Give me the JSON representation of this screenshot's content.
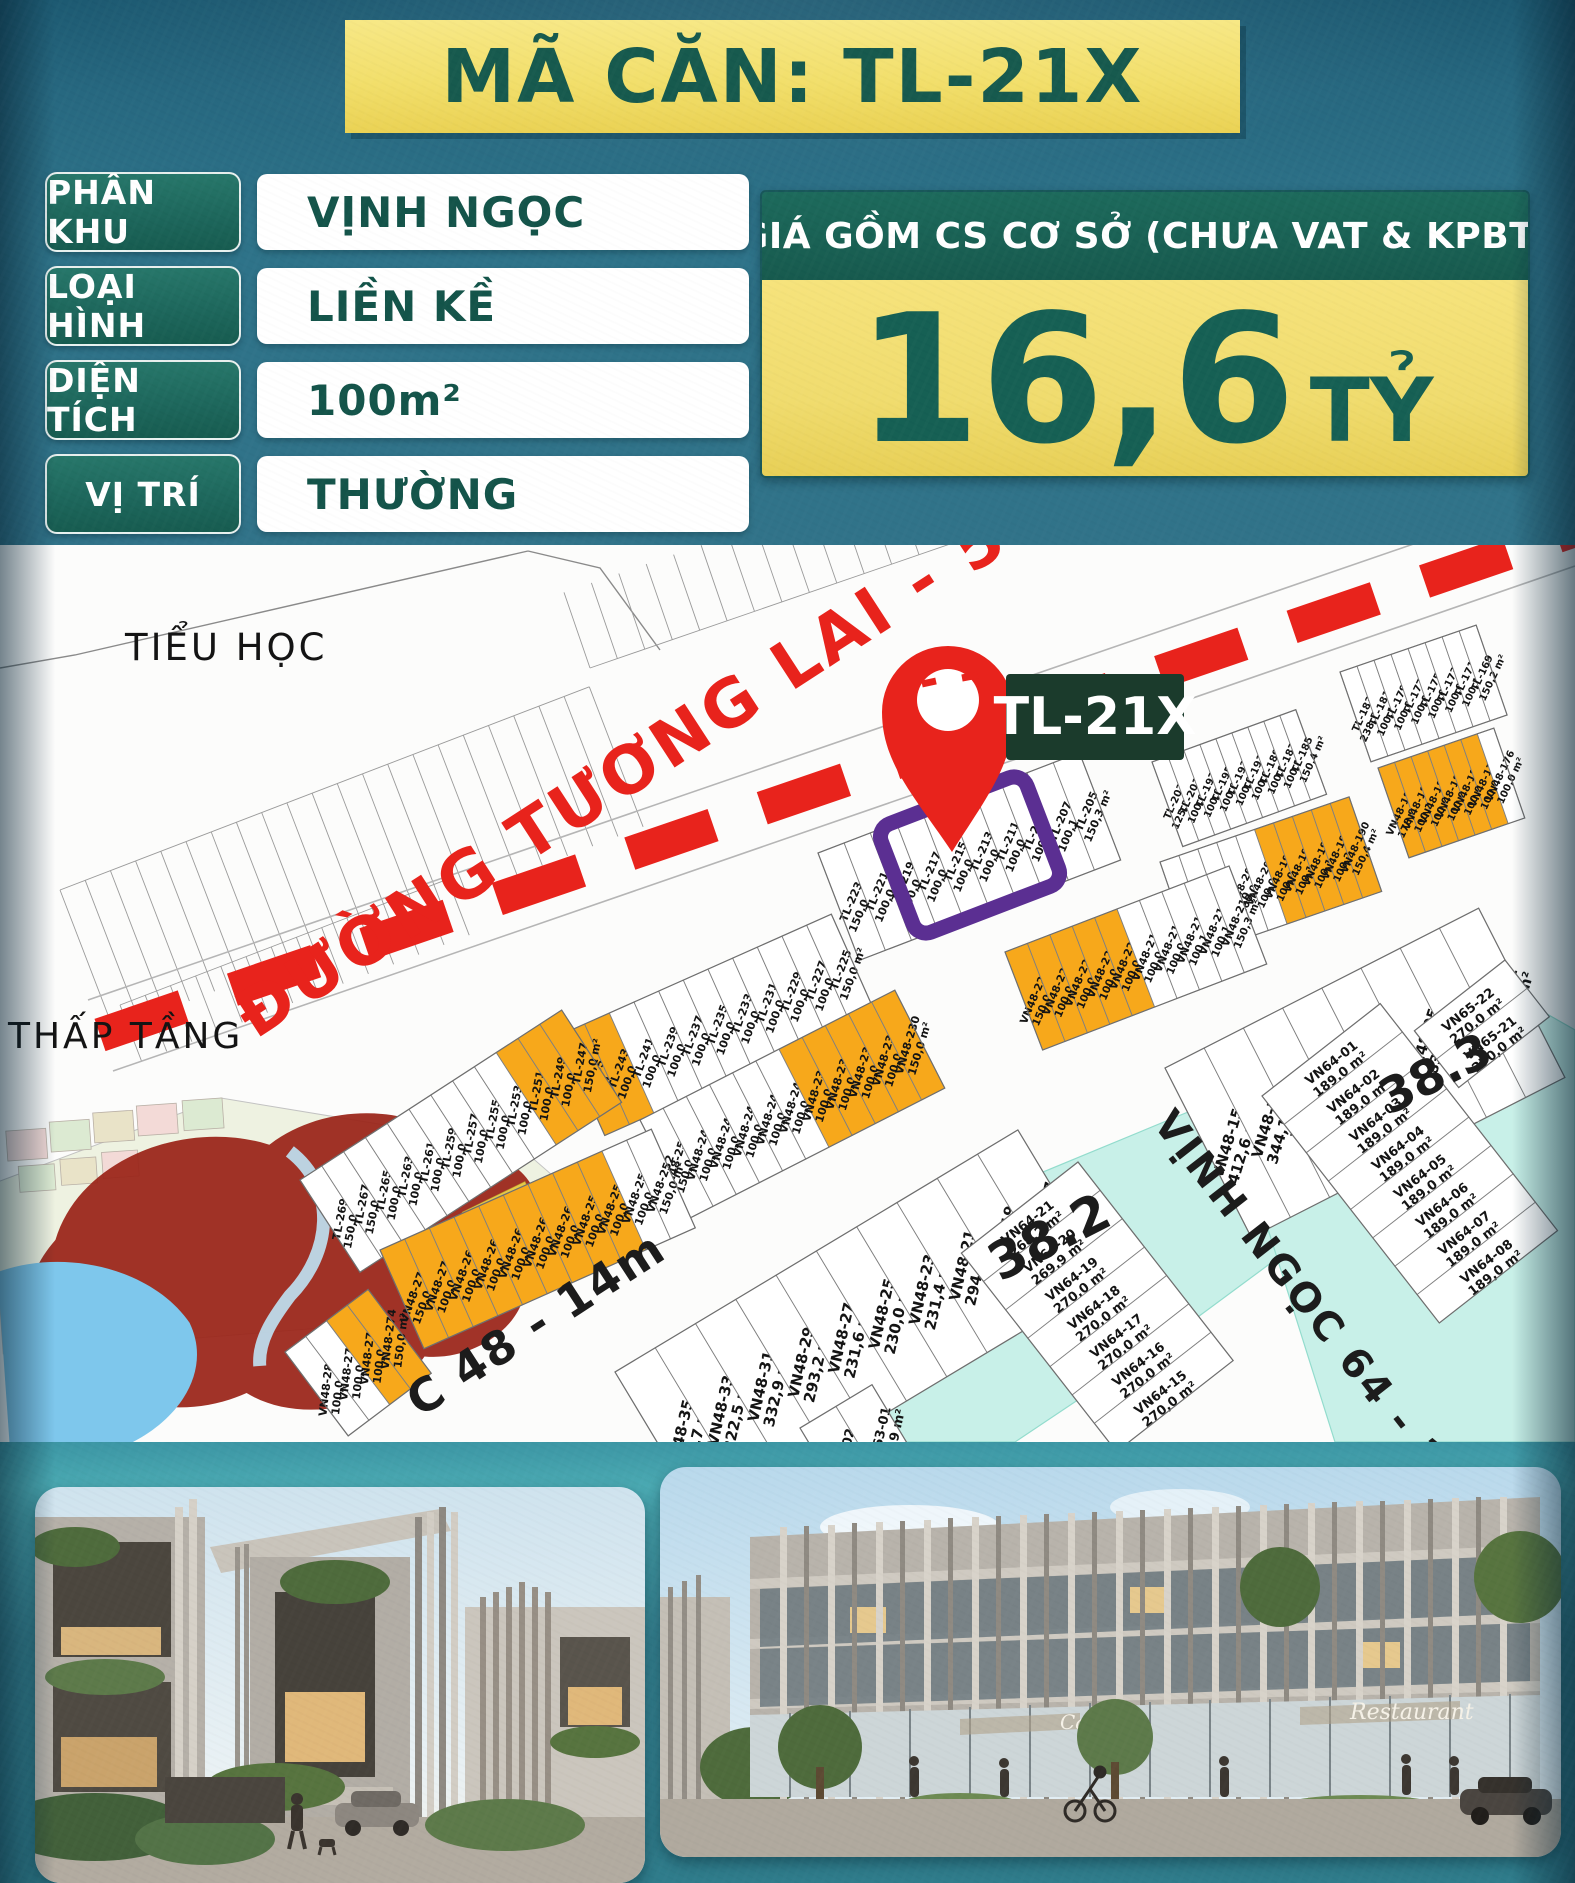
{
  "banner": {
    "title": "MÃ CĂN: TL-21X"
  },
  "info": {
    "rows": [
      {
        "label": "PHÂN KHU",
        "value": "VỊNH NGỌC"
      },
      {
        "label": "LOẠI HÌNH",
        "value": "LIỀN KỀ"
      },
      {
        "label": "DIỆN TÍCH",
        "value": "100m²"
      },
      {
        "label": "VỊ TRÍ",
        "value": "THƯỜNG"
      }
    ]
  },
  "price": {
    "header": "GIÁ GỒM CS CƠ SỞ (CHƯA VAT & KPBT)",
    "amount": "16,6",
    "unit": "TỶ"
  },
  "map": {
    "pin_label": "TL-21X",
    "labels": {
      "school": "TIỂU HỌC",
      "low_rise": "THẤP TẦNG",
      "future_road": "ĐƯỜNG TƯƠNG LAI - 50m",
      "road_48": "C 48 - 14m",
      "road_64": "VỊNH NGỌC 64 - 14m",
      "zone_38_2": "38.2",
      "zone_38_3": "38.3"
    },
    "bands": [
      {
        "key": "tl_169",
        "lots": [
          [
            "TL-183",
            "238,5 m²",
            0
          ],
          [
            "TL-181",
            "100,1 m²",
            0
          ],
          [
            "TL-179",
            "100,0 m²",
            0
          ],
          [
            "TL-177",
            "100,0 m²",
            0
          ],
          [
            "TL-175",
            "100,0 m²",
            0
          ],
          [
            "TL-173",
            "100,0 m²",
            0
          ],
          [
            "TL-171",
            "100,1 m²",
            0
          ],
          [
            "TL-169",
            "150,2 m²",
            0
          ]
        ]
      },
      {
        "key": "tl_185",
        "lots": [
          [
            "TL-203",
            "125,3 m²",
            0
          ],
          [
            "TL-201",
            "100,0 m²",
            0
          ],
          [
            "TL-197",
            "100,0 m²",
            0
          ],
          [
            "TL-195",
            "100,0 m²",
            0
          ],
          [
            "TL-193",
            "100,0 m²",
            0
          ],
          [
            "TL-191",
            "100,0 m²",
            0
          ],
          [
            "TL-189",
            "100,1 m²",
            0
          ],
          [
            "TL-187",
            "100,1 m²",
            0
          ],
          [
            "TL-185",
            "150,4 m²",
            0
          ]
        ]
      },
      {
        "key": "tl_205",
        "lots": [
          [
            "TL-223",
            "150,0 m²",
            0
          ],
          [
            "TL-221",
            "100,0 m²",
            0
          ],
          [
            "TL-219",
            "100,0 m²",
            0
          ],
          [
            "TL-217",
            "100,0 m²",
            0
          ],
          [
            "TL-215",
            "100,0 m²",
            0
          ],
          [
            "TL-213",
            "100,0 m²",
            0
          ],
          [
            "TL-211",
            "100,0 m²",
            0
          ],
          [
            "TL-209",
            "100,1 m²",
            0
          ],
          [
            "TL-207",
            "100,1 m²",
            0
          ],
          [
            "TL-205",
            "150,3 m²",
            0
          ]
        ]
      },
      {
        "key": "tl_225",
        "lots": [
          [
            "TL-245",
            "150,0 m²",
            1
          ],
          [
            "TL-243",
            "100,0 m²",
            1
          ],
          [
            "TL-241",
            "100,0 m²",
            0
          ],
          [
            "TL-239",
            "100,0 m²",
            0
          ],
          [
            "TL-237",
            "100,0 m²",
            0
          ],
          [
            "TL-235",
            "100,0 m²",
            0
          ],
          [
            "TL-233",
            "100,0 m²",
            0
          ],
          [
            "TL-231",
            "100,0 m²",
            0
          ],
          [
            "TL-229",
            "100,0 m²",
            0
          ],
          [
            "TL-227",
            "100,0 m²",
            0
          ],
          [
            "TL-225",
            "150,0 m²",
            0
          ]
        ]
      },
      {
        "key": "tl_247",
        "lots": [
          [
            "TL-269",
            "150,0 m²",
            0
          ],
          [
            "TL-267",
            "150,0 m²",
            0
          ],
          [
            "TL-265",
            "100,0 m²",
            0
          ],
          [
            "TL-263",
            "100,0 m²",
            0
          ],
          [
            "TL-261",
            "100,0 m²",
            0
          ],
          [
            "TL-259",
            "100,0 m²",
            0
          ],
          [
            "TL-257",
            "100,0 m²",
            0
          ],
          [
            "TL-255",
            "100,0 m²",
            0
          ],
          [
            "TL-253",
            "100,0 m²",
            0
          ],
          [
            "TL-251",
            "100,0 m²",
            1
          ],
          [
            "TL-249",
            "100,0 m²",
            1
          ],
          [
            "TL-247",
            "150,0 m²",
            1
          ]
        ]
      },
      {
        "key": "vn_176",
        "lots": [
          [
            "VN48-188",
            "178,9 m²",
            1
          ],
          [
            "VN48-186",
            "100,1 m²",
            1
          ],
          [
            "VN48-184",
            "100,0 m²",
            1
          ],
          [
            "VN48-182",
            "100,0 m²",
            1
          ],
          [
            "VN48-180",
            "100,0 m²",
            1
          ],
          [
            "VN48-178",
            "100,0 m²",
            1
          ],
          [
            "VN48-176",
            "100,0 m²",
            0
          ]
        ]
      },
      {
        "key": "vn_190",
        "lots": [
          [
            "VN48-208",
            "175,1 m²",
            0
          ],
          [
            "VN48-206",
            "100,0 m²",
            0
          ],
          [
            "VN48-204",
            "100,0 m²",
            0
          ],
          [
            "VN48-202",
            "100,0 m²",
            0
          ],
          [
            "VN48-200",
            "100,0 m²",
            0
          ],
          [
            "VN48-198",
            "100,0 m²",
            1
          ],
          [
            "VN48-196",
            "100,1 m²",
            1
          ],
          [
            "VN48-194",
            "100,1 m²",
            1
          ],
          [
            "VN48-192",
            "100,2 m²",
            1
          ],
          [
            "VN48-190",
            "150,4 m²",
            1
          ]
        ]
      },
      {
        "key": "vn_210",
        "lots": [
          [
            "VN48-228",
            "150,0 m²",
            1
          ],
          [
            "VN48-226",
            "100,0 m²",
            1
          ],
          [
            "VN48-224",
            "100,0 m²",
            1
          ],
          [
            "VN48-222",
            "100,0 m²",
            1
          ],
          [
            "VN48-220",
            "100,0 m²",
            1
          ],
          [
            "VN48-218",
            "100,0 m²",
            0
          ],
          [
            "VN48-216",
            "100,0 m²",
            0
          ],
          [
            "VN48-214",
            "100,1 m²",
            0
          ],
          [
            "VN48-212",
            "100,1 m²",
            0
          ],
          [
            "VN48-210",
            "150,3 m²",
            0
          ]
        ]
      },
      {
        "key": "vn_230",
        "lots": [
          [
            "VN48-250",
            "150,0 m²",
            0
          ],
          [
            "VN48-248",
            "100,0 m²",
            0
          ],
          [
            "VN48-246",
            "100,0 m²",
            0
          ],
          [
            "VN48-244",
            "100,0 m²",
            0
          ],
          [
            "VN48-242",
            "100,0 m²",
            0
          ],
          [
            "VN48-240",
            "100,0 m²",
            0
          ],
          [
            "VN48-238",
            "100,0 m²",
            1
          ],
          [
            "VN48-236",
            "100,0 m²",
            1
          ],
          [
            "VN48-234",
            "100,0 m²",
            1
          ],
          [
            "VN48-232",
            "100,0 m²",
            1
          ],
          [
            "VN48-230",
            "150,0 m²",
            1
          ]
        ]
      },
      {
        "key": "vn_252",
        "lots": [
          [
            "VN48-272",
            "150,0 m²",
            1
          ],
          [
            "VN48-270",
            "100,0 m²",
            1
          ],
          [
            "VN48-268",
            "100,0 m²",
            1
          ],
          [
            "VN48-266",
            "100,0 m²",
            1
          ],
          [
            "VN48-264",
            "100,0 m²",
            1
          ],
          [
            "VN48-262",
            "100,0 m²",
            1
          ],
          [
            "VN48-260",
            "100,0 m²",
            1
          ],
          [
            "VN48-258",
            "100,0 m²",
            1
          ],
          [
            "VN48-256",
            "100,0 m²",
            1
          ],
          [
            "VN48-254",
            "100,0 m²",
            0
          ],
          [
            "VN48-252",
            "150,0 m²",
            0
          ]
        ]
      },
      {
        "key": "vn_274",
        "lots": [
          [
            "VN48-280",
            "100,0 m²",
            0
          ],
          [
            "VN48-278",
            "100,0 m²",
            0
          ],
          [
            "VN48-276",
            "100,0 m²",
            1
          ],
          [
            "VN48-274",
            "150,0 m²",
            1
          ]
        ]
      },
      {
        "key": "vn_big1",
        "lots": [
          [
            "VN48-15",
            "412,6 m²",
            0
          ],
          [
            "VN48-13",
            "344,1 m²",
            0
          ],
          [
            "VN48-11",
            "287,9 m²",
            0
          ],
          [
            "VN48-09",
            "280,4 m²",
            0
          ],
          [
            "VN48-07",
            "288,3 m²",
            0
          ],
          [
            "VN48-05",
            "283,7 m²",
            0
          ],
          [
            "VN48-03",
            "369,7 m²",
            0
          ],
          [
            "VN48-01",
            "307,7 m²",
            0
          ]
        ]
      },
      {
        "key": "vn_big2",
        "lots": [
          [
            "VN48-35",
            "219,7 m²",
            0
          ],
          [
            "VN48-33",
            "222,5 m²",
            0
          ],
          [
            "VN48-31",
            "332,9 m²",
            0
          ],
          [
            "VN48-29",
            "293,2 m²",
            0
          ],
          [
            "VN48-27",
            "231,6 m²",
            0
          ],
          [
            "VN48-25",
            "230,0 m²",
            0
          ],
          [
            "VN48-23",
            "231,4 m²",
            0
          ],
          [
            "VN48-21",
            "294,9 m²",
            0
          ],
          [
            "VN48-19",
            "338,0 m²",
            0
          ],
          [
            "VN48-17",
            "318,0 m²",
            0
          ]
        ]
      },
      {
        "key": "vn63",
        "lots": [
          [
            "VN63-02",
            "",
            0
          ],
          [
            "VN63-01",
            "193,9 m²",
            0
          ]
        ]
      },
      {
        "key": "vn64r",
        "lots": [
          [
            "VN64-01",
            "189,0 m²",
            0
          ],
          [
            "VN64-02",
            "189,0 m²",
            0
          ],
          [
            "VN64-03",
            "189,0 m²",
            0
          ],
          [
            "VN64-04",
            "189,0 m²",
            0
          ],
          [
            "VN64-05",
            "189,0 m²",
            0
          ],
          [
            "VN64-06",
            "189,0 m²",
            0
          ],
          [
            "VN64-07",
            "189,0 m²",
            0
          ],
          [
            "VN64-08",
            "189,0 m²",
            0
          ]
        ]
      },
      {
        "key": "vn64l",
        "lots": [
          [
            "VN64-21",
            "268,2 m²",
            0
          ],
          [
            "VN64-20",
            "269,9 m²",
            0
          ],
          [
            "VN64-19",
            "270,0 m²",
            0
          ],
          [
            "VN64-18",
            "270,0 m²",
            0
          ],
          [
            "VN64-17",
            "270,0 m²",
            0
          ],
          [
            "VN64-16",
            "270,0 m²",
            0
          ],
          [
            "VN64-15",
            "270,0 m²",
            0
          ]
        ]
      },
      {
        "key": "vn65",
        "lots": [
          [
            "VN65-22",
            "270,0 m²",
            0
          ],
          [
            "VN65-21",
            "270,0 m²",
            0
          ]
        ]
      }
    ]
  },
  "photos": {
    "right_signs": [
      "Cafe",
      "Restaurant"
    ]
  },
  "colors": {
    "teal_bg": "#2e7389",
    "banner_yellow": "#f2df6b",
    "dark_green": "#175a4e",
    "price_green": "#166054",
    "lot_orange": "#f7a81b",
    "zone_cyan": "#c8f0e8",
    "highlight_purple": "#5b2f92",
    "road_red": "#e8231c",
    "pin_label_bg": "#1b3b2c"
  }
}
